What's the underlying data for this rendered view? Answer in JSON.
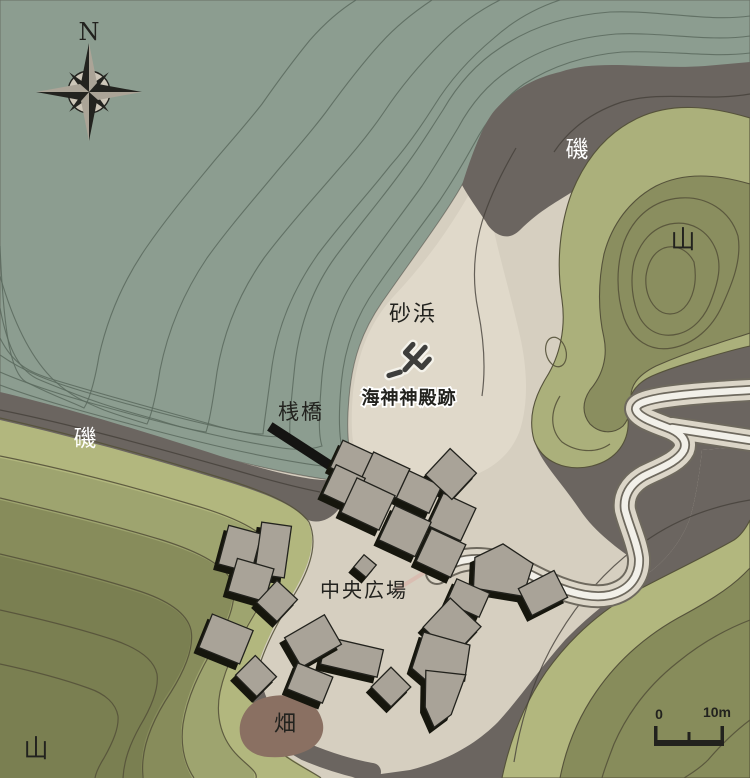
{
  "map": {
    "compass": {
      "north": "N"
    },
    "labels": {
      "rocky_shore_top": "磯",
      "rocky_shore_left": "磯",
      "mountain_right": "山",
      "mountain_bottom_left": "山",
      "sandy_beach": "砂浜",
      "pier": "桟橋",
      "sea_temple_ruins": "海神神殿跡",
      "central_plaza": "中央広場",
      "field": "畑"
    },
    "scale_bar": {
      "start": "0",
      "end": "10m"
    },
    "palette": {
      "sea": "#8C9D90",
      "seaContour": "#5A6A5E",
      "sand": "#D6CFC0",
      "beach": "#E0D9CA",
      "rock": "#6B6560",
      "rockContour": "#454039",
      "mtnLightNE": "#ABB07B",
      "mtnOliveNE": "#8A8E5F",
      "mtnLightSW": "#B2B77E",
      "mtnMidSW": "#9EA46F",
      "mtnOliveSW": "#878C5B",
      "mtnDarkSW": "#7A7F51",
      "mtnContour": "#55523A",
      "pathOuter": "#DCD6C8",
      "pathInner": "#F2F0E9",
      "pathEdge": "#6E695E",
      "building": "#A9A398",
      "buildingEdge": "#23231F",
      "field": "#8A7062",
      "pier": "#141412",
      "trident": "#3E3E3C",
      "labelDark": "#22221E",
      "labelWhite": "#FFFFFF",
      "compassDark": "#23231F",
      "compassLight": "#ABA497",
      "compassFace": "#CDC6B8",
      "plazaStub": "#D9BDB1"
    }
  }
}
